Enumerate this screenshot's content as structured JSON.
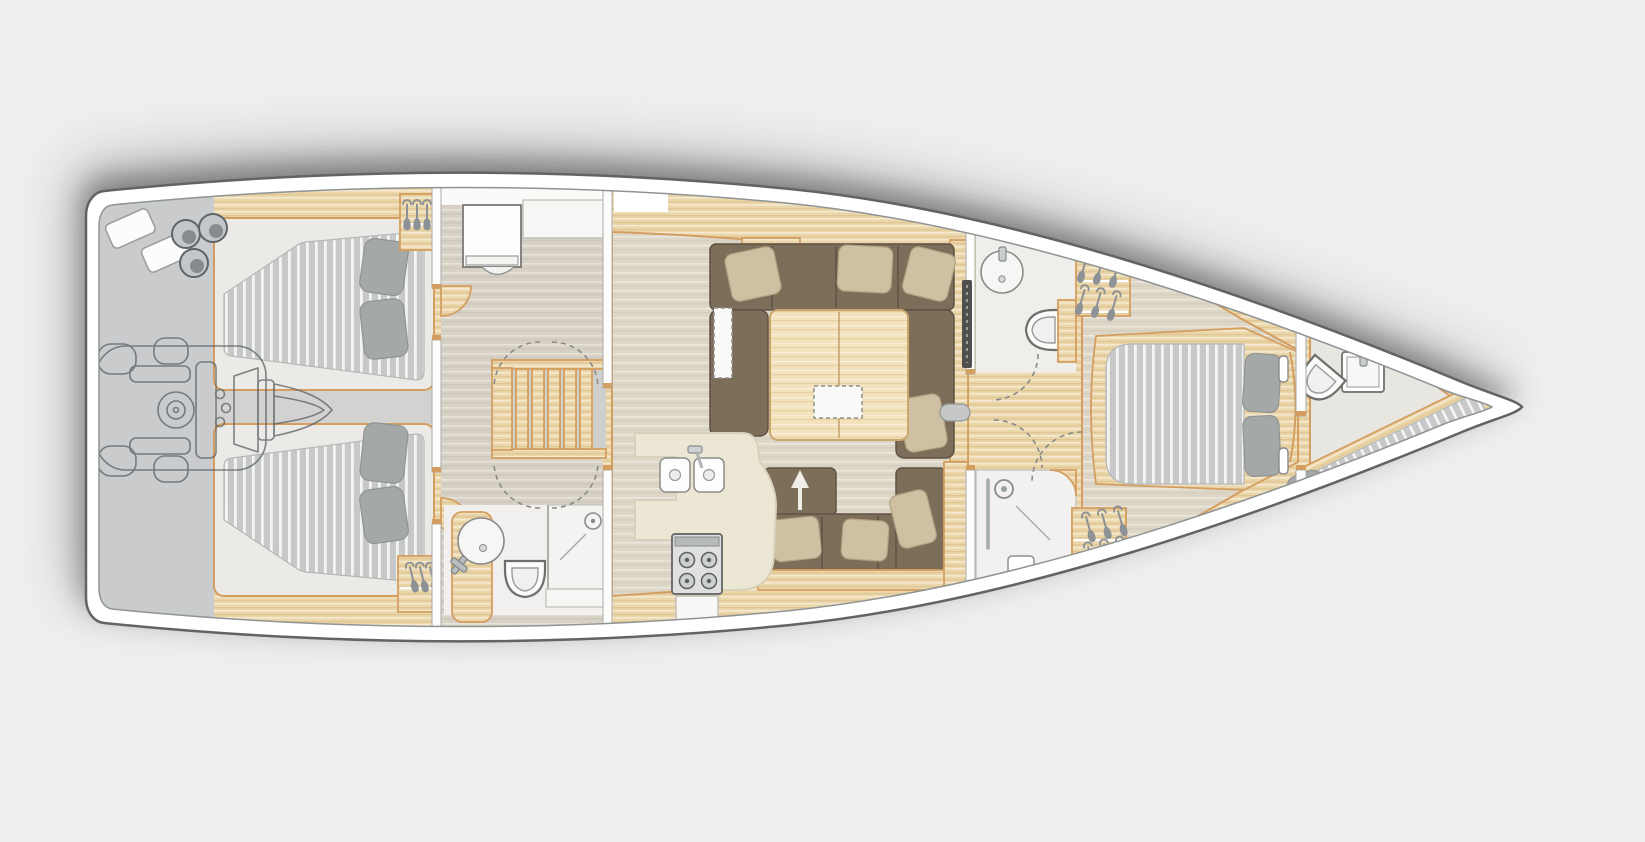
{
  "image_kind": "yacht-interior-deck-plan",
  "colors": {
    "bg": "#efefef",
    "hull": "#ffffff",
    "hullLine": "#5f6468",
    "deckLine": "#8f9494",
    "shadow": "#3b3b3b",
    "wood": "#ebd6a9",
    "woodLight": "#f3e3bd",
    "trim": "#d49e60",
    "floor": "#d8d2c6",
    "floorSalon": "#ded7c8",
    "grayLocker": "#c9cbcc",
    "grayStrip": "#d2d3d0",
    "mattress": "#c7c9c8",
    "mattressStripe": "#f3f4f3",
    "pillowGray": "#a4a8a7",
    "sofa": "#7d6e59",
    "pillowBeige": "#cec0a2",
    "cream": "#ece7d5",
    "fixture": "#f6f6f4",
    "tv": "#4f4f4f"
  },
  "rooms": [
    {
      "id": "stern-lazarette"
    },
    {
      "id": "aft-cabin-port"
    },
    {
      "id": "aft-cabin-starboard"
    },
    {
      "id": "engine-compartment"
    },
    {
      "id": "nav-desk-area"
    },
    {
      "id": "companionway-stairs"
    },
    {
      "id": "aft-head"
    },
    {
      "id": "galley"
    },
    {
      "id": "salon"
    },
    {
      "id": "day-head-wc"
    },
    {
      "id": "day-head-shower"
    },
    {
      "id": "owner-cabin"
    },
    {
      "id": "bow-cabin"
    }
  ],
  "icons": {
    "hanger": "clothes-hanger-icon",
    "toilet": "toilet-icon",
    "round_sink": "round-sink-icon",
    "double_sink": "double-sink-icon",
    "stove": "stove-4-burner-icon",
    "shower": "shower-head-icon",
    "engine": "engine-outline-icon",
    "gas_bottles": "gas-bottle-icons",
    "fenders": "fender-icons",
    "sofa_arrow": "convertible-sofa-arrow-icon"
  },
  "counts": {
    "double_beds": 3,
    "single_berths": 1,
    "toilets": 3,
    "showers": 2,
    "sinks_bath": 4,
    "hanging_lockers": 4
  }
}
